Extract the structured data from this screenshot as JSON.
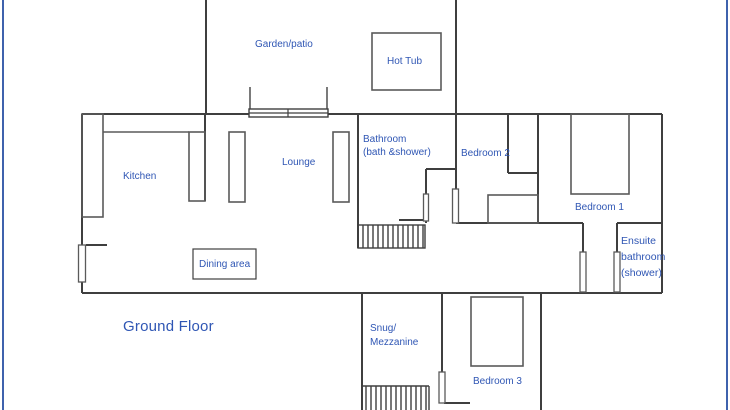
{
  "floor": {
    "label": "Ground Floor"
  },
  "rooms": {
    "garden": "Garden/patio",
    "hot_tub": "Hot Tub",
    "kitchen": "Kitchen",
    "lounge": "Lounge",
    "bathroom": "Bathroom\n(bath &shower)",
    "bedroom2": "Bedroom 2",
    "bedroom1": "Bedroom 1",
    "dining": "Dining area",
    "ensuite": "Ensuite\nbathroom\n(shower)",
    "snug": "Snug/\nMezzanine",
    "bedroom3": "Bedroom 3"
  },
  "colors": {
    "frame": "#3f62ad",
    "wall": "#3f3f3f",
    "furniture": "#5a5a5a",
    "label": "#2f56b4"
  }
}
